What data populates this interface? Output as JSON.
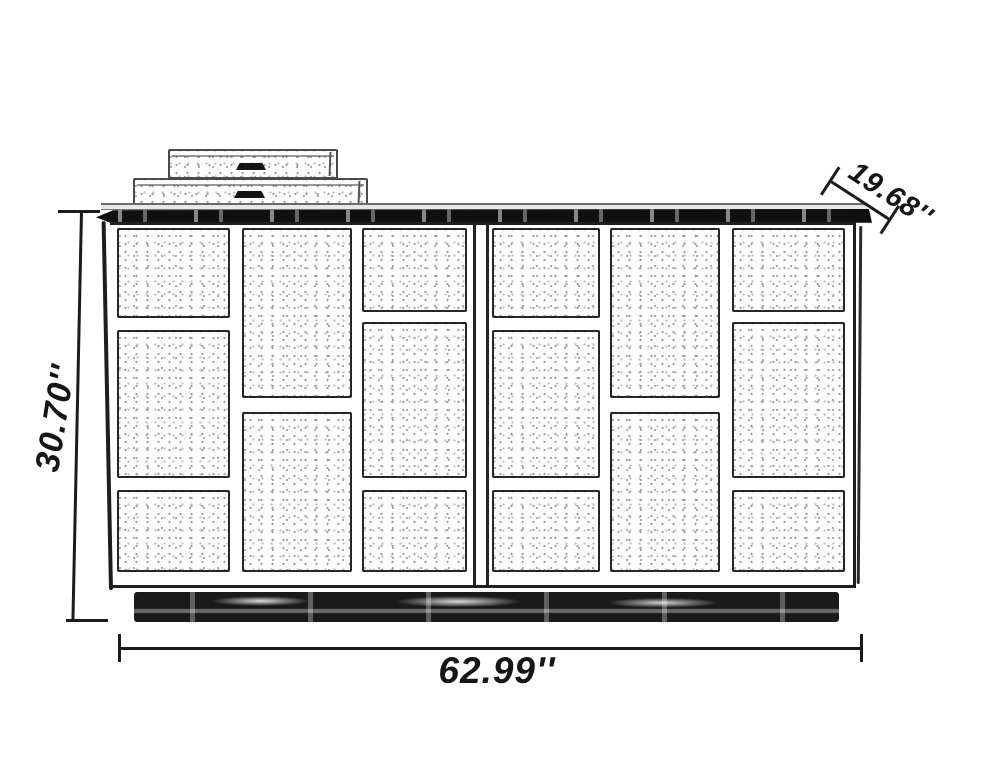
{
  "dimensions": {
    "height": "30.70''",
    "width": "62.99''",
    "depth": "19.68''"
  },
  "colors": {
    "line": "#1b1b1b",
    "panel_speckle": "#9e9e9e",
    "background": "#ffffff"
  }
}
